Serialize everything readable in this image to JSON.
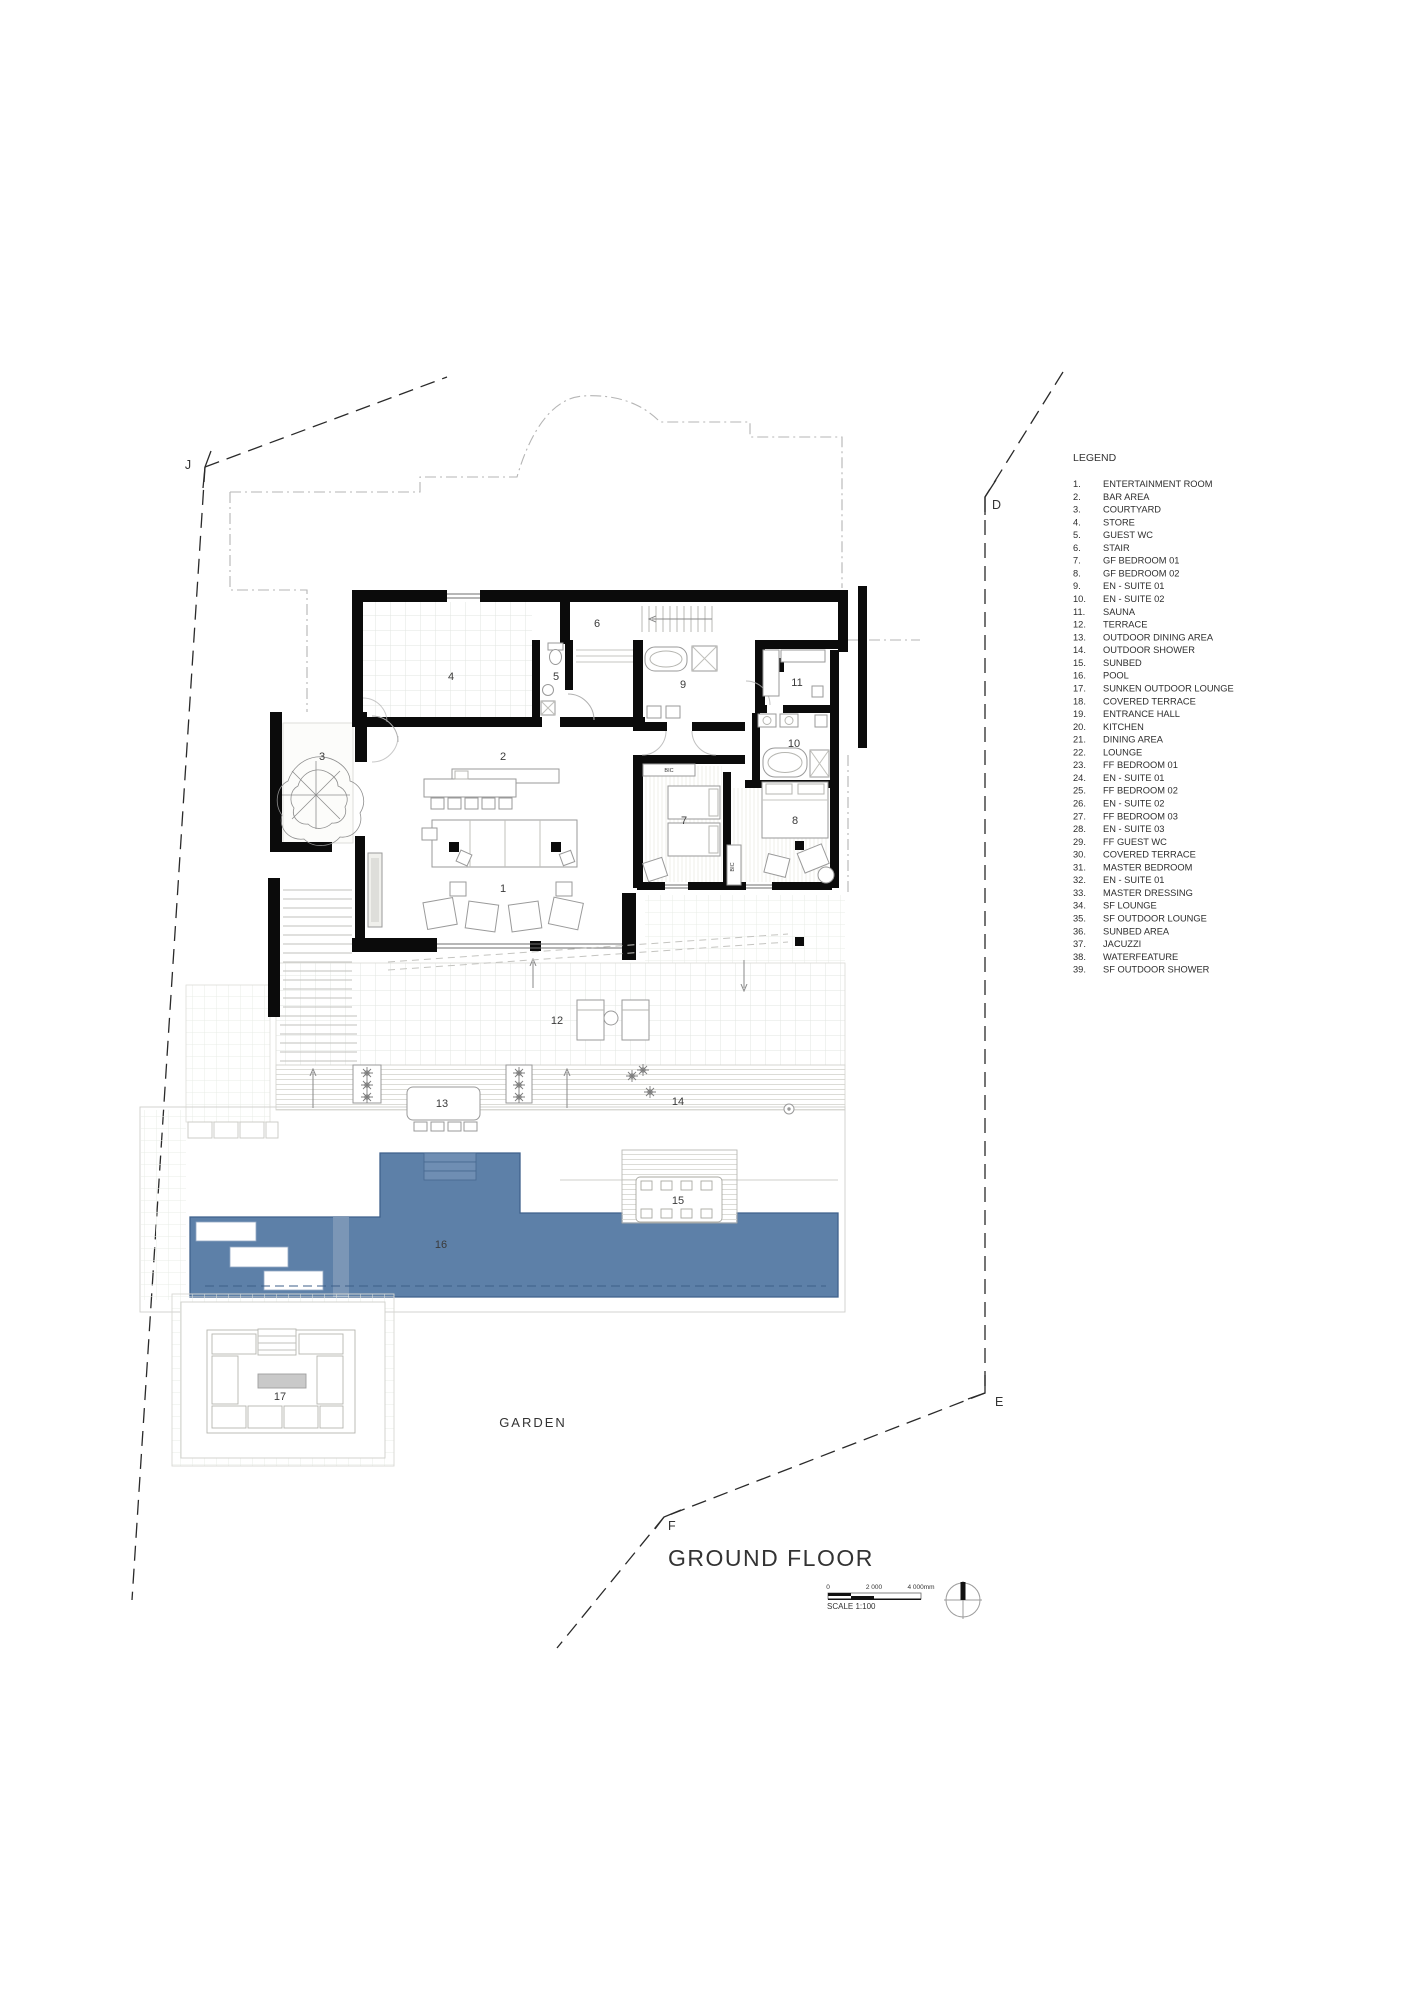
{
  "title": "GROUND FLOOR",
  "garden": "GARDEN",
  "boundary": {
    "j": "J",
    "d": "D",
    "e": "E",
    "f": "F"
  },
  "scalebar": {
    "t0": "0",
    "t1": "2 000",
    "t2": "4 000mm",
    "label": "SCALE 1:100"
  },
  "legend": {
    "heading": "LEGEND",
    "items": [
      {
        "n": "1.",
        "label": "ENTERTAINMENT ROOM"
      },
      {
        "n": "2.",
        "label": "BAR AREA"
      },
      {
        "n": "3.",
        "label": "COURTYARD"
      },
      {
        "n": "4.",
        "label": "STORE"
      },
      {
        "n": "5.",
        "label": "GUEST WC"
      },
      {
        "n": "6.",
        "label": "STAIR"
      },
      {
        "n": "7.",
        "label": "GF BEDROOM 01"
      },
      {
        "n": "8.",
        "label": "GF BEDROOM 02"
      },
      {
        "n": "9.",
        "label": "EN - SUITE 01"
      },
      {
        "n": "10.",
        "label": "EN - SUITE 02"
      },
      {
        "n": "11.",
        "label": "SAUNA"
      },
      {
        "n": "12.",
        "label": "TERRACE"
      },
      {
        "n": "13.",
        "label": "OUTDOOR DINING AREA"
      },
      {
        "n": "14.",
        "label": "OUTDOOR SHOWER"
      },
      {
        "n": "15.",
        "label": "SUNBED"
      },
      {
        "n": "16.",
        "label": "POOL"
      },
      {
        "n": "17.",
        "label": "SUNKEN OUTDOOR LOUNGE"
      },
      {
        "n": "18.",
        "label": "COVERED TERRACE"
      },
      {
        "n": "19.",
        "label": "ENTRANCE HALL"
      },
      {
        "n": "20.",
        "label": "KITCHEN"
      },
      {
        "n": "21.",
        "label": "DINING AREA"
      },
      {
        "n": "22.",
        "label": "LOUNGE"
      },
      {
        "n": "23.",
        "label": "FF BEDROOM 01"
      },
      {
        "n": "24.",
        "label": "EN - SUITE 01"
      },
      {
        "n": "25.",
        "label": "FF BEDROOM 02"
      },
      {
        "n": "26.",
        "label": "EN - SUITE 02"
      },
      {
        "n": "27.",
        "label": "FF BEDROOM 03"
      },
      {
        "n": "28.",
        "label": "EN - SUITE 03"
      },
      {
        "n": "29.",
        "label": "FF GUEST WC"
      },
      {
        "n": "30.",
        "label": "COVERED TERRACE"
      },
      {
        "n": "31.",
        "label": "MASTER BEDROOM"
      },
      {
        "n": "32.",
        "label": "EN - SUITE 01"
      },
      {
        "n": "33.",
        "label": "MASTER DRESSING"
      },
      {
        "n": "34.",
        "label": "SF LOUNGE"
      },
      {
        "n": "35.",
        "label": "SF OUTDOOR LOUNGE"
      },
      {
        "n": "36.",
        "label": "SUNBED AREA"
      },
      {
        "n": "37.",
        "label": "JACUZZI"
      },
      {
        "n": "38.",
        "label": "WATERFEATURE"
      },
      {
        "n": "39.",
        "label": "SF OUTDOOR SHOWER"
      }
    ]
  },
  "plan": {
    "bic": "BIC",
    "rooms": [
      {
        "n": "1",
        "x": 503,
        "y": 892
      },
      {
        "n": "2",
        "x": 503,
        "y": 760
      },
      {
        "n": "3",
        "x": 322,
        "y": 760
      },
      {
        "n": "4",
        "x": 451,
        "y": 680
      },
      {
        "n": "5",
        "x": 556,
        "y": 680
      },
      {
        "n": "6",
        "x": 597,
        "y": 627
      },
      {
        "n": "7",
        "x": 684,
        "y": 824
      },
      {
        "n": "8",
        "x": 795,
        "y": 824
      },
      {
        "n": "9",
        "x": 683,
        "y": 688
      },
      {
        "n": "10",
        "x": 794,
        "y": 747
      },
      {
        "n": "11",
        "x": 797,
        "y": 686
      },
      {
        "n": "12",
        "x": 557,
        "y": 1024
      },
      {
        "n": "13",
        "x": 442,
        "y": 1107
      },
      {
        "n": "14",
        "x": 678,
        "y": 1105
      },
      {
        "n": "15",
        "x": 678,
        "y": 1204
      },
      {
        "n": "16",
        "x": 441,
        "y": 1248
      },
      {
        "n": "17",
        "x": 280,
        "y": 1400
      }
    ]
  },
  "colors": {
    "pool": "#5d80a8",
    "pool_edge": "#3f618c",
    "pool_step": "#6f8eb3",
    "wall": "#0b0b0b",
    "table_grey": "#c9c9c9"
  }
}
